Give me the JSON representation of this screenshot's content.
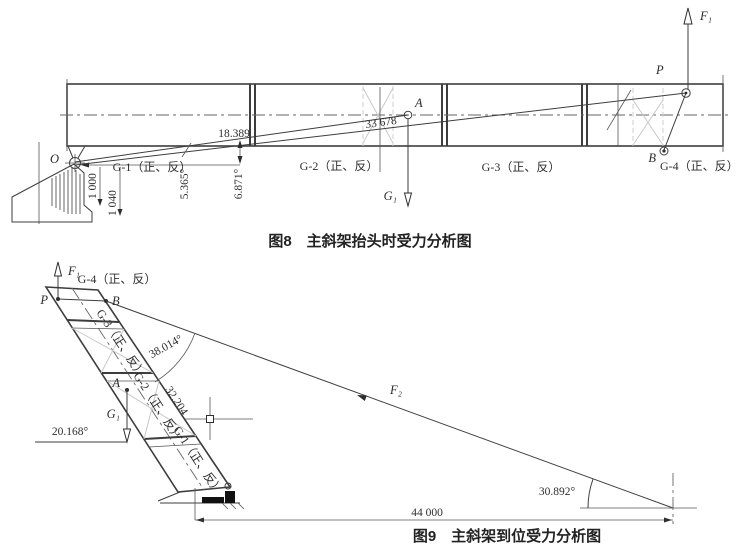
{
  "fig8": {
    "caption": "图8　主斜架抬头时受力分析图",
    "points": {
      "o": "O",
      "a": "A",
      "b": "B",
      "p": "P"
    },
    "forces": {
      "f1": "F₁",
      "g1": "G₁"
    },
    "segments": [
      "G-1（正、反）",
      "G-2（正、反）",
      "G-3（正、反）",
      "G-4（正、反）"
    ],
    "dims": {
      "height_mid": "18.389",
      "tie_length": "33 678",
      "angle_left": "5.365°",
      "angle_right": "6.871°",
      "pivot_h1": "1 000",
      "pivot_h2": "1 040"
    }
  },
  "fig9": {
    "caption": "图9　主斜架到位受力分析图",
    "points": {
      "a": "A",
      "b": "B",
      "p": "P"
    },
    "forces": {
      "f1": "F₁",
      "g1": "G₁",
      "f2": "F₂"
    },
    "segments": [
      "G-1（正、反）",
      "G-2（正、反）",
      "G-3（正、反）",
      "G-4（正、反）"
    ],
    "dims": {
      "tie_angle": "38.014°",
      "frame_length": "32.204",
      "g1_angle": "20.168°",
      "ground_angle": "30.892°",
      "ground_span": "44 000"
    }
  }
}
